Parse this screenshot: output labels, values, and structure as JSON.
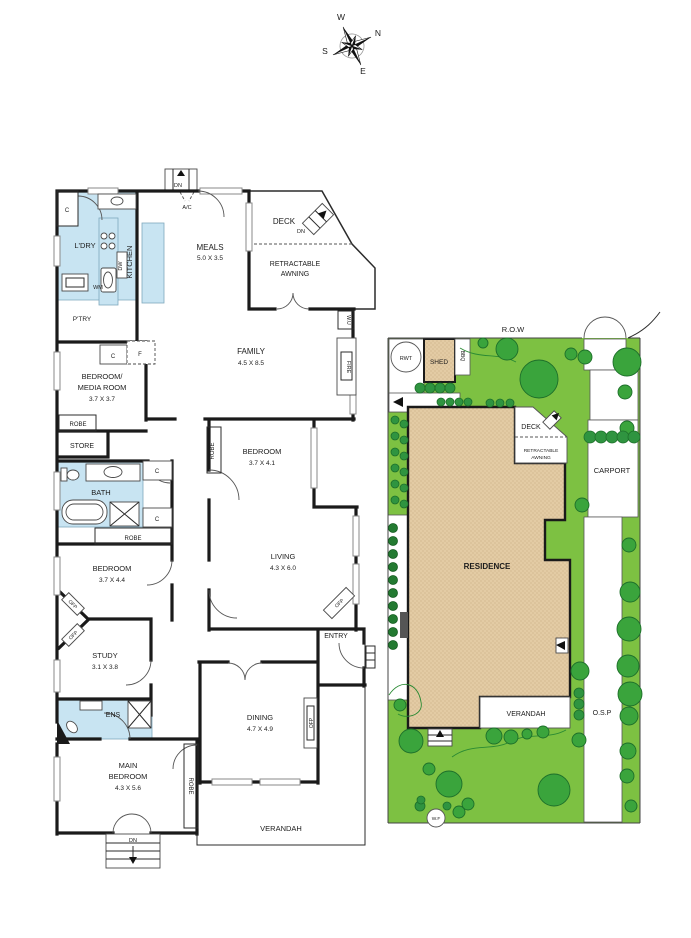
{
  "colors": {
    "wall": "#1a1a1a",
    "wet": "#c8e4f2",
    "sand": "#e3cba4",
    "grass": "#7dc142",
    "tree": "#3aa43c",
    "shrub": "#2f9440",
    "text": "#1c1c1c"
  },
  "compass": {
    "west": "W",
    "north": "N",
    "south": "S",
    "east": "E"
  },
  "floorplan": {
    "closet_top": "C",
    "laundry": "L'DRY",
    "washer": "WM",
    "dishwasher": "DW",
    "kitchen": "KITCHEN",
    "pantry": "P'TRY",
    "cab_c": "C",
    "cab_f": "F",
    "meals": {
      "name": "MEALS",
      "dims": "5.0 X 3.5"
    },
    "stairs_top": {
      "dn": "DN",
      "ac": "A/C"
    },
    "deck": {
      "name": "DECK",
      "dn": "DN"
    },
    "awning": {
      "line1": "RETRACTABLE",
      "line2": "AWNING"
    },
    "family": {
      "name": "FAMILY",
      "dims": "4.5 X 8.5",
      "wu": "W.U",
      "fire": "FIRE"
    },
    "bed_media": {
      "line1": "BEDROOM/",
      "line2": "MEDIA ROOM",
      "dims": "3.7 X 3.7",
      "robe": "ROBE"
    },
    "store": "STORE",
    "bedroom2": {
      "name": "BEDROOM",
      "dims": "3.7 X 4.1",
      "robe": "ROBE"
    },
    "bath": {
      "name": "BATH",
      "c1": "C",
      "c2": "C",
      "robe": "ROBE"
    },
    "bedroom3": {
      "name": "BEDROOM",
      "dims": "3.7 X 4.4",
      "ofp": "OFP"
    },
    "study": {
      "name": "STUDY",
      "dims": "3.1 X 3.8",
      "ofp": "OFP"
    },
    "ens": "ENS",
    "living": {
      "name": "LIVING",
      "dims": "4.3 X 6.0",
      "ofp": "OFP"
    },
    "entry": "ENTRY",
    "dining": {
      "name": "DINING",
      "dims": "4.7 X 4.9",
      "ofp": "OFP"
    },
    "main_bedroom": {
      "line1": "MAIN",
      "line2": "BEDROOM",
      "dims": "4.3 X 5.6",
      "robe": "ROBE"
    },
    "verandah": "VERANDAH",
    "stairs_bottom": {
      "dn": "DN"
    }
  },
  "siteplan": {
    "row": "R.O.W",
    "rwt": "RWT",
    "shed": "SHED",
    "bbq": "BBQ",
    "deck": "DECK",
    "awning_line1": "RETRACTABLE",
    "awning_line2": "AWNING",
    "carport": "CARPORT",
    "residence": "RESIDENCE",
    "verandah": "VERANDAH",
    "osp": "O.S.P",
    "wf": "W.F"
  }
}
